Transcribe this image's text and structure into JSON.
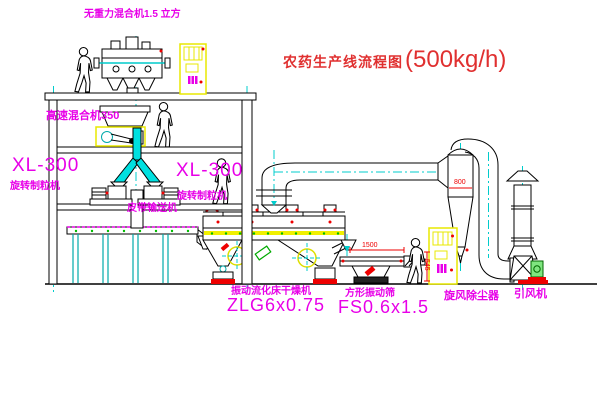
{
  "title": {
    "name": "农药生产线流程图",
    "capacity": "(500kg/h)"
  },
  "equipment_labels": {
    "gravity_free_mixer": "无重力混合机1.5 立方",
    "high_speed_mixer": "高速混合机350",
    "granulator_left_model": "XL-300",
    "granulator_left_name": "旋转制粒机",
    "granulator_center_model": "XL-300",
    "granulator_center_name": "旋转制粒机",
    "belt_conveyor": "皮带输送机",
    "fluid_bed_dryer_name": "振动流化床干燥机",
    "fluid_bed_dryer_model": "ZLG6x0.75",
    "square_sieve_name": "方形振动筛",
    "square_sieve_model": "FS0.6x1.5",
    "cyclone_dust_collector": "旋风除尘器",
    "induced_draft_fan": "引风机"
  },
  "dimensions": {
    "sieve_length": "1500",
    "sieve_height": "545",
    "cyclone_diameter": "800"
  },
  "colors": {
    "label_magenta": "#e800e8",
    "title_red": "#e03030",
    "dimension_red": "#ee0000",
    "centerline_cyan": "#00cccc",
    "equipment_yellow": "#e8e800",
    "line_black": "#000000"
  }
}
